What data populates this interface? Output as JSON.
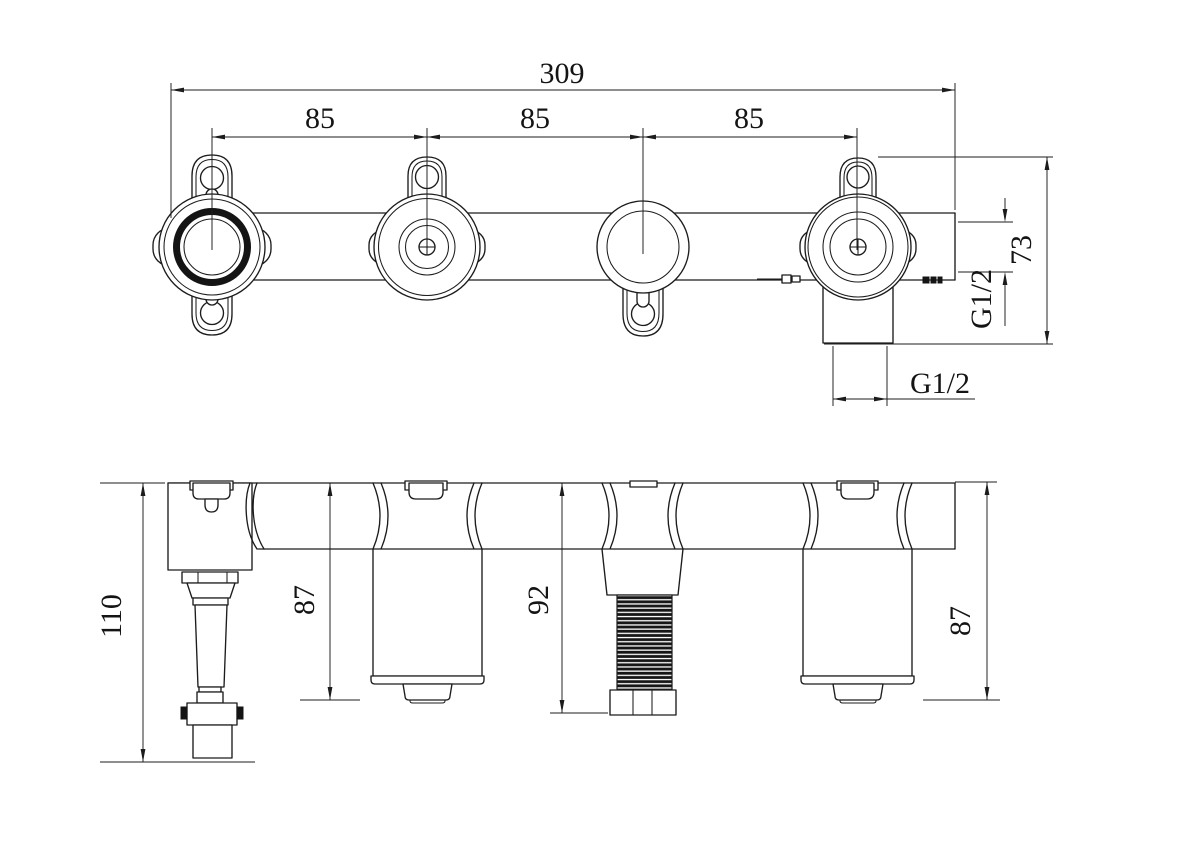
{
  "drawing": {
    "style": {
      "ink_color": "#1c1c1c",
      "background_color": "#ffffff"
    },
    "top_view": {
      "dim_overall_width": "309",
      "dim_spacing": [
        "85",
        "85",
        "85"
      ],
      "dim_height": "73",
      "dim_side_port_thread": "G1/2",
      "dim_bottom_port_thread": "G1/2"
    },
    "front_view": {
      "dim_total_height": "110",
      "dim_left_cartridge_height": "87",
      "dim_stud_height": "92",
      "dim_right_cartridge_height": "87"
    }
  }
}
